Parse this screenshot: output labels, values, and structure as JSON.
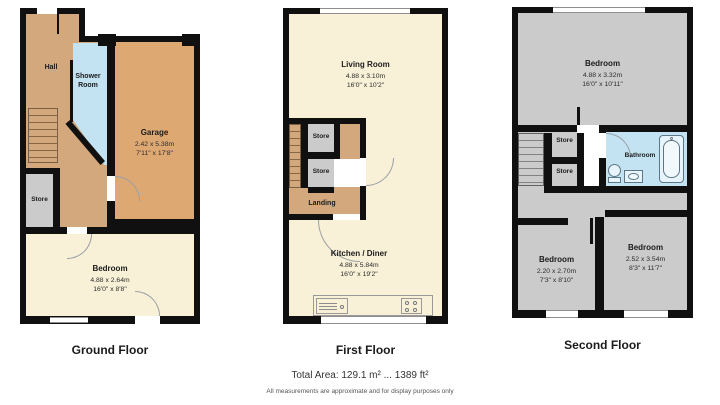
{
  "colors": {
    "wall": "#101010",
    "hall_tan": "#d3a87d",
    "garage_tan": "#dea873",
    "cream": "#f8f1d7",
    "room_gray": "#cbcbcb",
    "water_blue": "#c3e3f2"
  },
  "floors": [
    {
      "caption": "Ground Floor",
      "rooms": {
        "hall": {
          "name": "Hall"
        },
        "shower_room": {
          "name": "Shower Room"
        },
        "garage": {
          "name": "Garage",
          "metric": "2.42 x 5.38m",
          "imperial": "7'11\" x 17'8\""
        },
        "store": {
          "name": "Store"
        },
        "bedroom": {
          "name": "Bedroom",
          "metric": "4.88 x 2.64m",
          "imperial": "16'0\" x 8'8\""
        }
      }
    },
    {
      "caption": "First Floor",
      "rooms": {
        "living_room": {
          "name": "Living Room",
          "metric": "4.88 x 3.10m",
          "imperial": "16'0\" x 10'2\""
        },
        "store_upper": {
          "name": "Store"
        },
        "store_lower": {
          "name": "Store"
        },
        "landing": {
          "name": "Landing"
        },
        "kitchen_diner": {
          "name": "Kitchen / Diner",
          "metric": "4.88 x 5.84m",
          "imperial": "16'0\" x 19'2\""
        }
      }
    },
    {
      "caption": "Second Floor",
      "rooms": {
        "bedroom_main": {
          "name": "Bedroom",
          "metric": "4.88 x 3.32m",
          "imperial": "16'0\" x 10'11\""
        },
        "store_upper": {
          "name": "Store"
        },
        "store_lower": {
          "name": "Store"
        },
        "bathroom": {
          "name": "Bathroom"
        },
        "bedroom_left": {
          "name": "Bedroom",
          "metric": "2.20 x 2.70m",
          "imperial": "7'3\" x 8'10\""
        },
        "bedroom_right": {
          "name": "Bedroom",
          "metric": "2.52 x 3.54m",
          "imperial": "8'3\" x 11'7\""
        }
      }
    }
  ],
  "footer": {
    "total_area": "Total Area: 129.1 m² ... 1389 ft²",
    "disclaimer": "All measurements are approximate and for display purposes only"
  }
}
